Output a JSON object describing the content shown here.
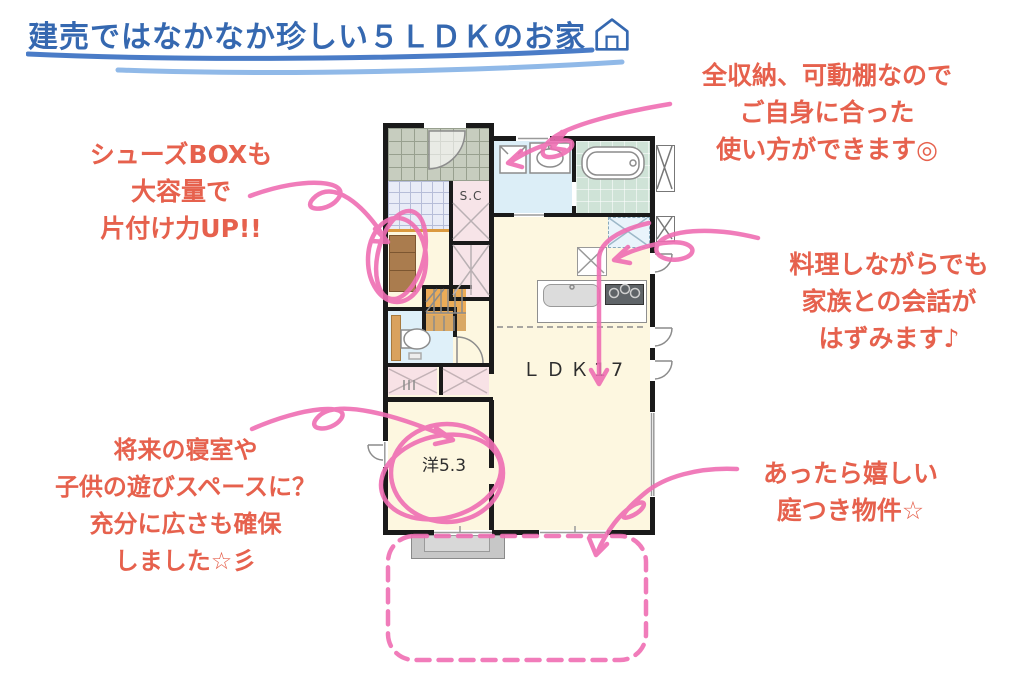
{
  "title": {
    "text": "建売ではなかなか珍しい５ＬＤＫのお家",
    "icon": "house"
  },
  "floorplan": {
    "ldk_label": "ＬＤＫ17",
    "western_room_label": "洋5.3",
    "shoe_closet_label": "S.C"
  },
  "annotations": {
    "storage": {
      "lines": [
        "全収納、可動棚なので",
        "ご自身に合った",
        "使い方ができます◎"
      ]
    },
    "shoes": {
      "lines": [
        "シューズBOXも",
        "大容量で",
        "片付け力UP!!"
      ]
    },
    "cooking": {
      "lines": [
        "料理しながらでも",
        "家族との会話が",
        "はずみます♪"
      ]
    },
    "future_room": {
      "lines": [
        "将来の寝室や",
        "子供の遊びスペースに？",
        "充分に広さも確保",
        "しました☆彡"
      ]
    },
    "garden": {
      "lines": [
        "あったら嬉しい",
        "庭つき物件☆"
      ]
    }
  },
  "colors": {
    "title_blue": "#3568b0",
    "underline_blue": "#4a7cc7",
    "underline_light_blue": "#90b9e8",
    "note_red": "#e6614d",
    "marker_pink": "#ef6eb3"
  }
}
